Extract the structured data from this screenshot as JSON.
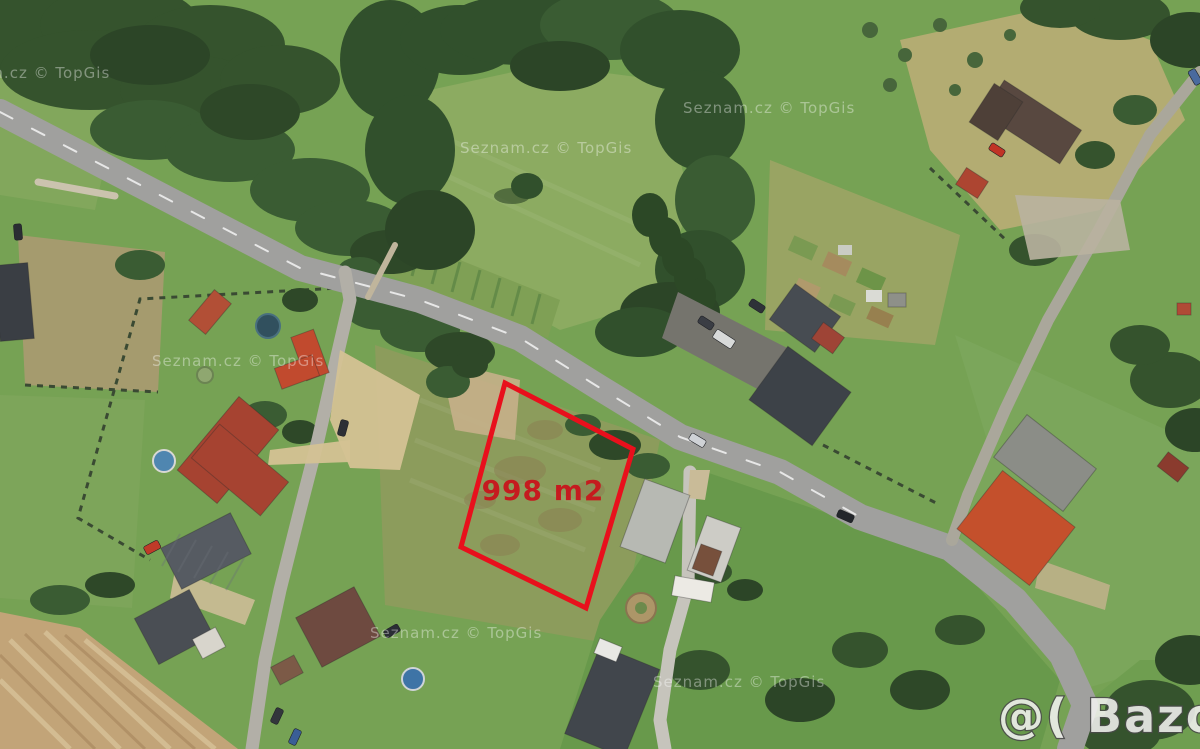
{
  "map": {
    "annotation": {
      "area_label": "998 m2"
    },
    "watermark_provider": "Seznam.cz © TopGis",
    "watermark_site": "@( Bazos.cz"
  },
  "colors": {
    "plot_outline": "#e8101c",
    "area_text": "#c9151c",
    "watermark_text": "#ffffff",
    "site_watermark_fill": "#f2f2f0",
    "site_watermark_outline": "#4a4a4a",
    "road": "#a0a09e",
    "side_road": "#aaa79b",
    "street": "#b2afa7",
    "driveway": "#c6c4bc",
    "grass_base": "#76a254",
    "tree_green": "#35532d",
    "plowed_field": "#c2a478",
    "red_roof": "#a64331",
    "orange_roof": "#c4502c",
    "dark_roof": "#3d4248"
  }
}
